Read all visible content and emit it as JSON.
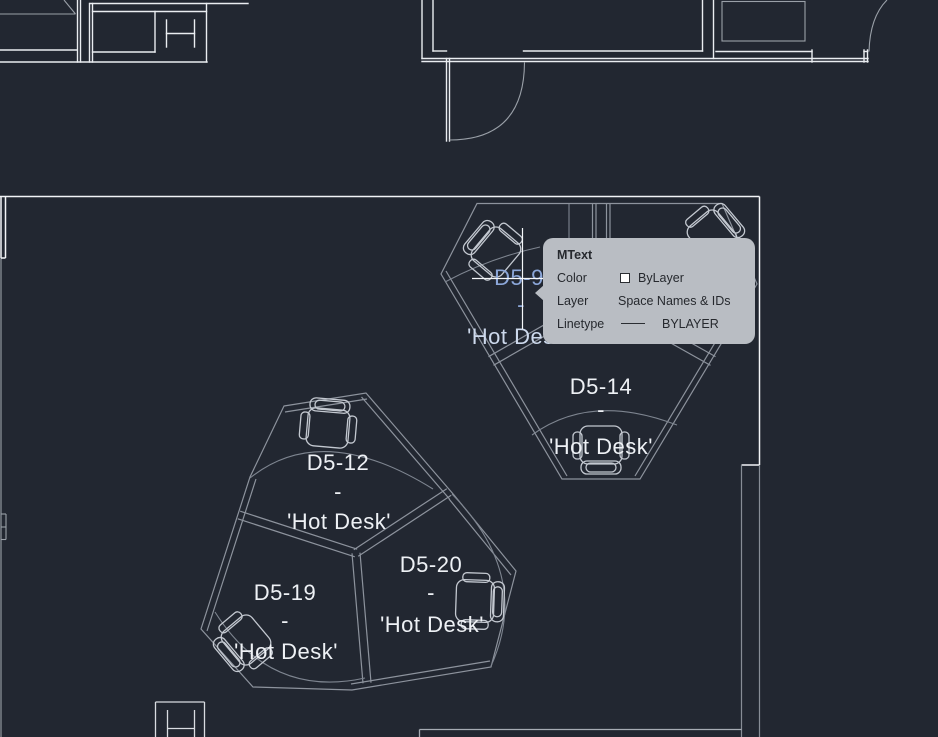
{
  "app": {
    "type": "cad-floorplan-viewer",
    "hover_tooltip_visible": true
  },
  "tooltip": {
    "title": "MText",
    "rows": [
      {
        "label": "Color",
        "value": "ByLayer",
        "glyph": "white-color-swatch"
      },
      {
        "label": "Layer",
        "value": "Space Names & IDs"
      },
      {
        "label": "Linetype",
        "value": "BYLAYER",
        "glyph": "continuous-line"
      }
    ]
  },
  "desk_labels": [
    {
      "id": "D5-9",
      "separator": "-",
      "name": "'Hot Desk'",
      "highlighted": true
    },
    {
      "id": "D5-14",
      "separator": "-",
      "name": "'Hot Desk'",
      "highlighted": false
    },
    {
      "id": "D5-12",
      "separator": "-",
      "name": "'Hot Desk'",
      "highlighted": false
    },
    {
      "id": "D5-19",
      "separator": "-",
      "name": "'Hot Desk'",
      "highlighted": false
    },
    {
      "id": "D5-20",
      "separator": "-",
      "name": "'Hot Desk'",
      "highlighted": false
    }
  ],
  "colors": {
    "background": "#222731",
    "wall_bright": "#eaedf1",
    "room_boundary": "#f2f4f7",
    "cluster_gray": "#8d939d",
    "desk_dim": "#7e8590",
    "chair_outline": "#c3c8d0",
    "label_white": "#eef1f5",
    "highlight_blue": "#8ba6d8",
    "highlight_pale": "#cdd9ec",
    "tooltip_background": "#b9bdc3",
    "tooltip_text": "#26292e",
    "color_swatch": "#ffffff"
  }
}
